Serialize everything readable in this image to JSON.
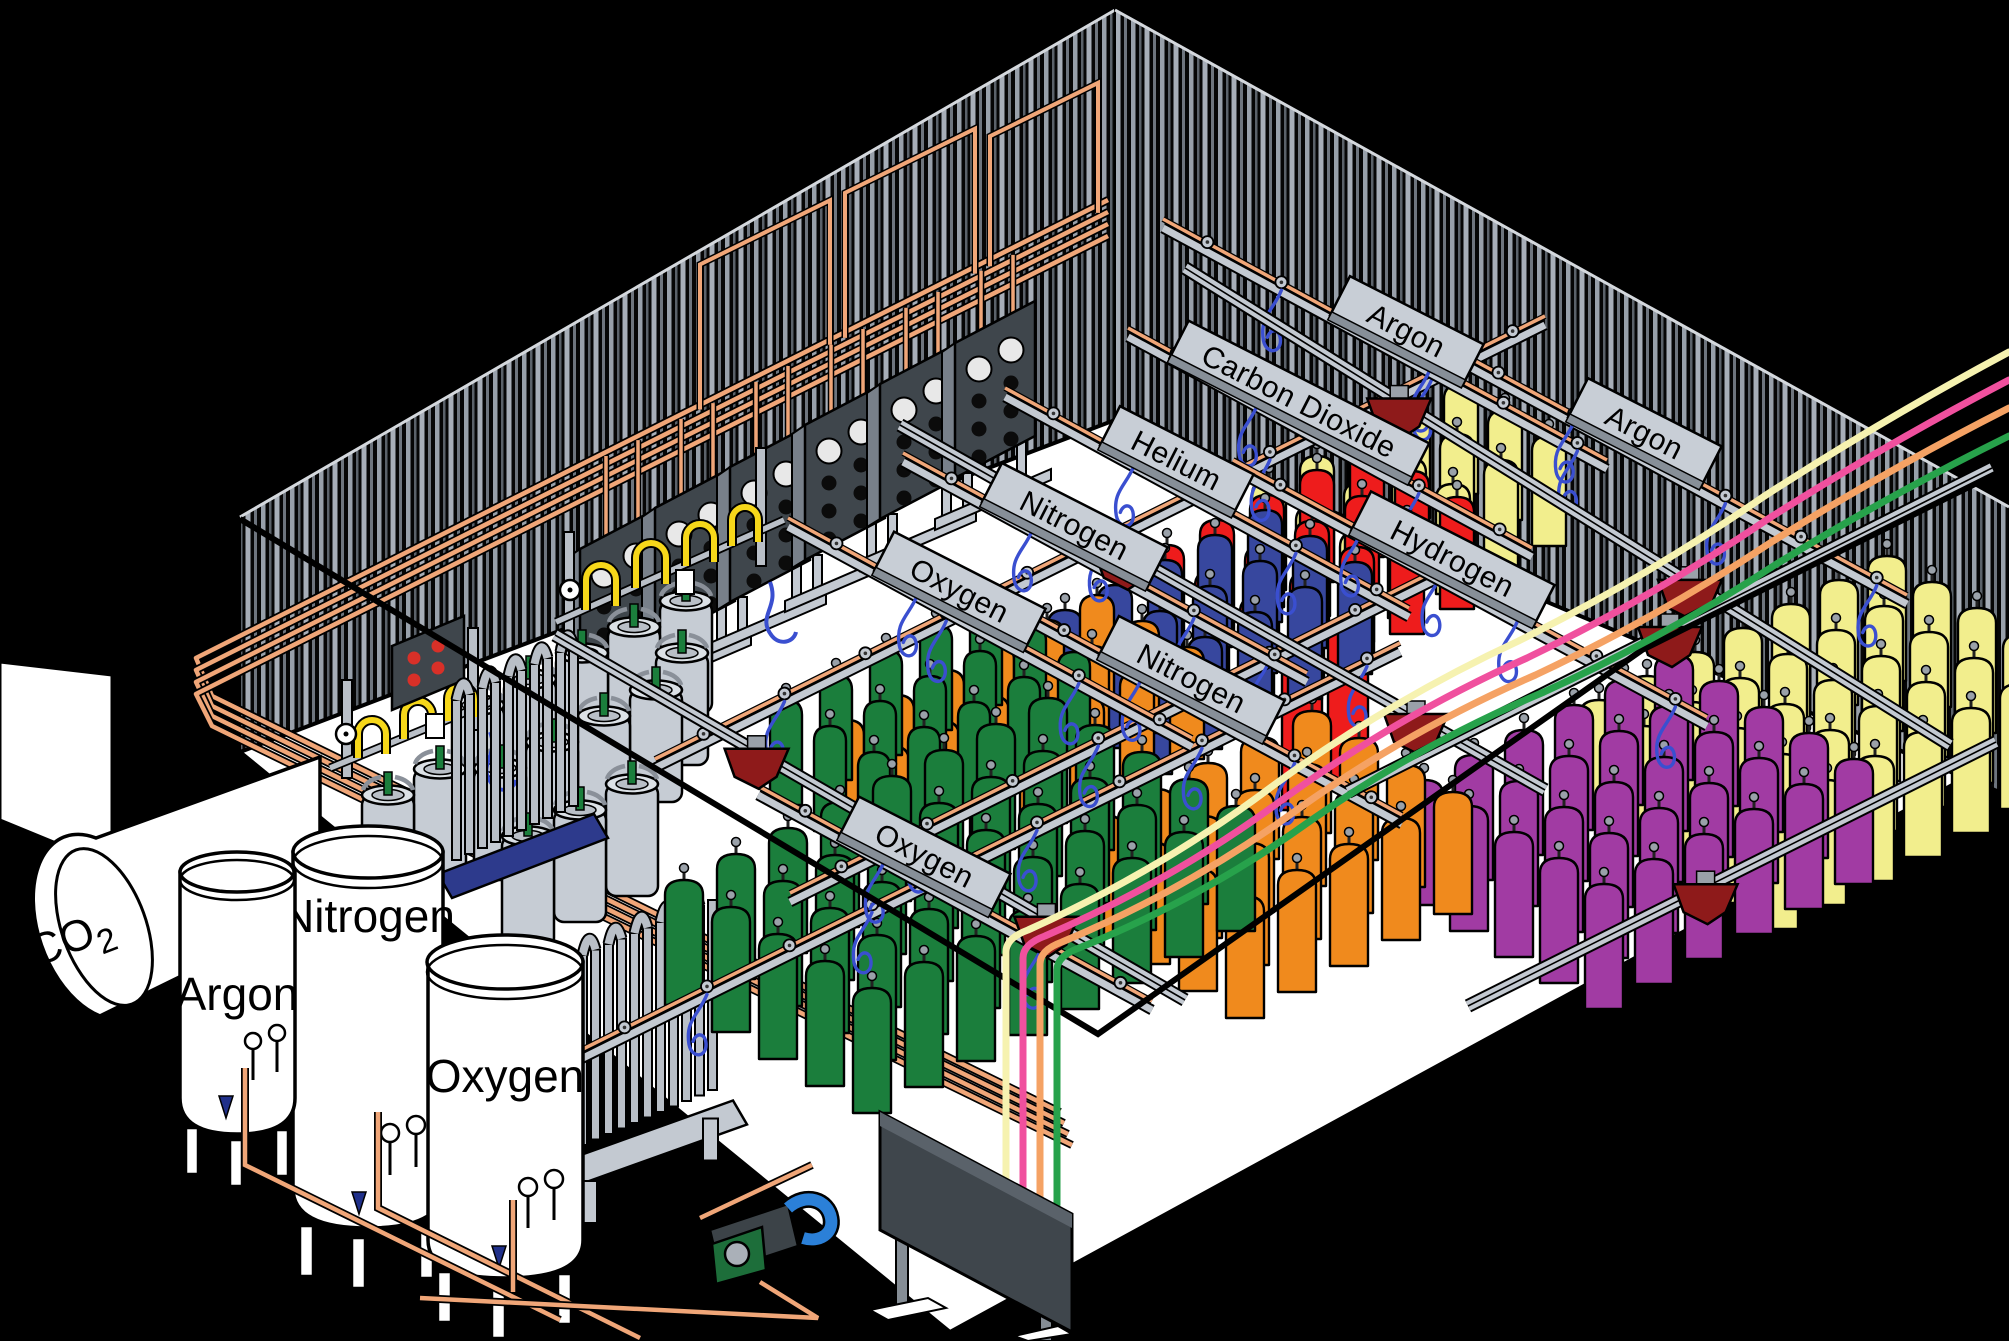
{
  "title": "Gas cylinder filling plant - isometric illustration",
  "labels": {
    "co2_main": "CO",
    "co2_sub": "2",
    "tank_argon": "Argon",
    "tank_nitrogen": "Nitrogen",
    "tank_oxygen": "Oxygen"
  },
  "signs": [
    {
      "id": "oxygen-front",
      "label": "Oxygen"
    },
    {
      "id": "nitrogen-front",
      "label": "Nitrogen"
    },
    {
      "id": "oxygen-back",
      "label": "Oxygen"
    },
    {
      "id": "nitrogen-back",
      "label": "Nitrogen"
    },
    {
      "id": "helium",
      "label": "Helium"
    },
    {
      "id": "carbon-dioxide",
      "label": "Carbon Dioxide"
    },
    {
      "id": "argon-top",
      "label": "Argon"
    },
    {
      "id": "hydrogen",
      "label": "Hydrogen"
    },
    {
      "id": "argon-right",
      "label": "Argon"
    }
  ],
  "colors": {
    "bg": "#000000",
    "floor": "#ffffff",
    "outline": "#000000",
    "stripe_a": "#98a0aa",
    "stripe_b": "#5b626a",
    "stripe_c": "#a7aeb8",
    "stripe_d": "#6e757e",
    "wall_fill": "#060606",
    "edge_light": "#d4d8dd",
    "green": "#1b7e3c",
    "orange": "#f08a1d",
    "blue": "#37479e",
    "red": "#ee1c1c",
    "yellow": "#f2ee8d",
    "purple": "#a13ba3",
    "copper": "#f0a678",
    "rail": "#c3c9d1",
    "rail_dark": "#858d95",
    "hopper": "#8e1a1a",
    "hose": "#3a4fd0",
    "sign": "#c8ced6",
    "sign_edge": "#878f98",
    "panel": "#3f464c",
    "panel_tab": "#78808a",
    "dewar": "#c6ccd4",
    "dewar_top": "#b9bfc7",
    "pigtail": "#f6d71a",
    "vapor": "#b9bfc7",
    "platform_blue": "#2d3a8c",
    "pump_green": "#1d6e3a",
    "pump_body": "#3c4348",
    "pump_hose": "#2b80d8",
    "flex_cream": "#f6f2b0",
    "flex_pink": "#f0509e",
    "flex_salmon": "#f5a264",
    "flex_green": "#27a24b",
    "indicator_red": "#d83028",
    "valve_gray": "#9aa1a9",
    "tank_white": "#ffffff"
  },
  "render": {
    "wall_panels": [
      {
        "x": 580,
        "y": 549
      },
      {
        "x": 655,
        "y": 508
      },
      {
        "x": 730,
        "y": 467
      },
      {
        "x": 805,
        "y": 425
      },
      {
        "x": 880,
        "y": 384
      },
      {
        "x": 955,
        "y": 343
      }
    ],
    "copper_frames": [
      {
        "x1": 700,
        "x2": 830,
        "h": 145
      },
      {
        "x1": 845,
        "x2": 975,
        "h": 145
      },
      {
        "x1": 990,
        "x2": 1098,
        "h": 130
      }
    ],
    "dewars": [
      [
        686,
        601
      ],
      [
        634,
        627
      ],
      [
        682,
        653
      ],
      [
        582,
        653
      ],
      [
        530,
        679
      ],
      [
        656,
        690
      ],
      [
        478,
        705
      ],
      [
        604,
        716
      ],
      [
        552,
        742
      ],
      [
        500,
        768
      ],
      [
        440,
        769
      ],
      [
        632,
        784
      ],
      [
        388,
        795
      ],
      [
        580,
        810
      ],
      [
        528,
        836
      ]
    ],
    "cylinder_fields": [
      {
        "name": "carbon-dioxide-yellow",
        "color": "yellow",
        "x": 1252,
        "y": 480,
        "cols": 5,
        "rows": 3,
        "dux": 48,
        "duy": -24,
        "dvx": 44,
        "dvy": 26,
        "w": 34,
        "h": 110
      },
      {
        "name": "helium-red",
        "color": "red",
        "x": 1150,
        "y": 545,
        "cols": 5,
        "rows": 3,
        "dux": 50,
        "duy": -25,
        "dvx": 45,
        "dvy": 26,
        "w": 34,
        "h": 112
      },
      {
        "name": "helium-red-tall",
        "color": "red",
        "x": 1282,
        "y": 640,
        "cols": 2,
        "rows": 1,
        "dux": 46,
        "duy": -23,
        "dvx": 45,
        "dvy": 26,
        "w": 40,
        "h": 170
      },
      {
        "name": "nitrogen-blue",
        "color": "blue",
        "x": 1048,
        "y": 610,
        "cols": 5,
        "rows": 3,
        "dux": 50,
        "duy": -25,
        "dvx": 45,
        "dvy": 26,
        "w": 34,
        "h": 112
      },
      {
        "name": "oxygen-orange-back",
        "color": "orange",
        "x": 830,
        "y": 720,
        "cols": 6,
        "rows": 3,
        "dux": 50,
        "duy": -25,
        "dvx": 45,
        "dvy": 26,
        "w": 34,
        "h": 112
      },
      {
        "name": "oxygen-green-back",
        "color": "green",
        "x": 770,
        "y": 700,
        "cols": 5,
        "rows": 3,
        "dux": 50,
        "duy": -25,
        "dvx": 44,
        "dvy": 26,
        "w": 32,
        "h": 105
      },
      {
        "name": "argon-yellow-right",
        "color": "yellow",
        "x": 1580,
        "y": 700,
        "cols": 7,
        "rows": 5,
        "dux": 48,
        "duy": -24,
        "dvx": 45,
        "dvy": 26,
        "w": 38,
        "h": 125
      },
      {
        "name": "hydrogen-purple",
        "color": "purple",
        "x": 1405,
        "y": 780,
        "cols": 6,
        "rows": 5,
        "dux": 50,
        "duy": -25,
        "dvx": 45,
        "dvy": 26,
        "w": 38,
        "h": 125
      },
      {
        "name": "oxygen-orange-front",
        "color": "orange",
        "x": 1085,
        "y": 815,
        "cols": 5,
        "rows": 4,
        "dux": 52,
        "duy": -26,
        "dvx": 47,
        "dvy": 27,
        "w": 38,
        "h": 122
      },
      {
        "name": "oxygen-green-front",
        "color": "green",
        "x": 665,
        "y": 880,
        "cols": 8,
        "rows": 5,
        "dux": 52,
        "duy": -26,
        "dvx": 47,
        "dvy": 27,
        "w": 38,
        "h": 125
      }
    ],
    "rails": [
      {
        "x1": 575,
        "y1": 1062,
        "x2": 1400,
        "y2": 652,
        "n": 10
      },
      {
        "x1": 790,
        "y1": 902,
        "x2": 1475,
        "y2": 560,
        "n": 8
      },
      {
        "x1": 655,
        "y1": 768,
        "x2": 1545,
        "y2": 325,
        "n": 11
      },
      {
        "x1": 758,
        "y1": 795,
        "x2": 1152,
        "y2": 1010,
        "n": 5
      },
      {
        "x1": 1018,
        "y1": 615,
        "x2": 1402,
        "y2": 824,
        "n": 5
      },
      {
        "x1": 788,
        "y1": 527,
        "x2": 1192,
        "y2": 747,
        "n": 5
      },
      {
        "x1": 903,
        "y1": 462,
        "x2": 1307,
        "y2": 682,
        "n": 5
      },
      {
        "x1": 1005,
        "y1": 397,
        "x2": 1409,
        "y2": 617,
        "n": 5
      },
      {
        "x1": 1128,
        "y1": 337,
        "x2": 1532,
        "y2": 557,
        "n": 5
      },
      {
        "x1": 1163,
        "y1": 228,
        "x2": 1607,
        "y2": 469,
        "n": 6
      },
      {
        "x1": 1233,
        "y1": 469,
        "x2": 1707,
        "y2": 726,
        "n": 6
      },
      {
        "x1": 1453,
        "y1": 358,
        "x2": 1907,
        "y2": 604,
        "n": 6
      }
    ],
    "beams": [
      {
        "x1": 555,
        "y1": 635,
        "x2": 1185,
        "y2": 1000,
        "hoppers": [
          0.32,
          0.78
        ]
      },
      {
        "x1": 900,
        "y1": 425,
        "x2": 1545,
        "y2": 790,
        "hoppers": [
          0.35,
          0.8
        ]
      },
      {
        "x1": 1185,
        "y1": 268,
        "x2": 1950,
        "y2": 745,
        "hoppers": [
          0.28,
          0.66
        ]
      },
      {
        "x1": 1348,
        "y1": 792,
        "x2": 1992,
        "y2": 468,
        "hoppers": [
          0.5
        ]
      },
      {
        "x1": 1468,
        "y1": 1006,
        "x2": 1996,
        "y2": 742,
        "hoppers": [
          0.45
        ]
      }
    ],
    "flex_lines": [
      {
        "color": "flex_cream",
        "x0": 1006,
        "yT": 952,
        "ey": 352
      },
      {
        "color": "flex_pink",
        "x0": 1023,
        "yT": 958,
        "ey": 380
      },
      {
        "color": "flex_salmon",
        "x0": 1040,
        "yT": 964,
        "ey": 408
      },
      {
        "color": "flex_green",
        "x0": 1057,
        "yT": 970,
        "ey": 436
      }
    ],
    "wall_bundle": {
      "k": 4,
      "x1": 1108,
      "y1": 200,
      "x2": 196,
      "y2": 658,
      "ex": 1060,
      "eyb": 1112
    },
    "vaporizers": [
      {
        "x": 452,
        "y": 700,
        "n": 10,
        "h": 160,
        "sp": 13,
        "rise": 6,
        "base": "blue"
      },
      {
        "x": 578,
        "y": 955,
        "n": 11,
        "h": 190,
        "sp": 13,
        "rise": 5.5,
        "base": "gray"
      }
    ]
  }
}
